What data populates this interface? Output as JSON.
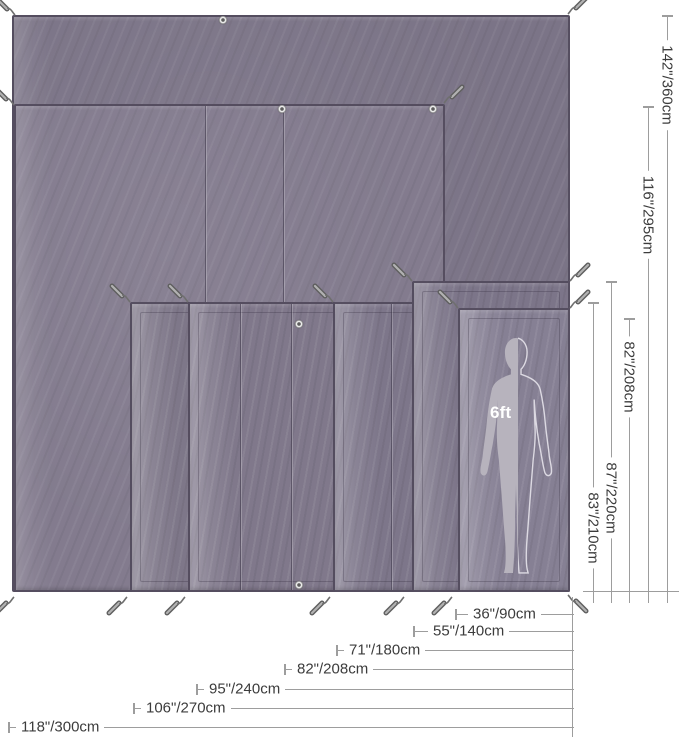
{
  "figure": {
    "background": "#ffffff",
    "scale_reference": {
      "label": "6ft"
    },
    "height_dimensions": [
      {
        "label": "142\"/360cm",
        "line_x": 667,
        "top_y": 15,
        "label_center_y": 85
      },
      {
        "label": "116\"/295cm",
        "line_x": 648,
        "top_y": 106,
        "label_center_y": 215
      },
      {
        "label": "82\"/208cm",
        "line_x": 629,
        "top_y": 318,
        "label_center_y": 377
      },
      {
        "label": "87\"/220cm",
        "line_x": 611,
        "top_y": 281,
        "label_center_y": 498
      },
      {
        "label": "83\"/210cm",
        "line_x": 593,
        "top_y": 302,
        "label_center_y": 528
      }
    ],
    "width_dimensions": [
      {
        "label": "36\"/90cm",
        "line_y": 614,
        "tick_x": 455,
        "text_x": 468
      },
      {
        "label": "55\"/140cm",
        "line_y": 631,
        "tick_x": 413,
        "text_x": 428
      },
      {
        "label": "71\"/180cm",
        "line_y": 650,
        "tick_x": 336,
        "text_x": 344
      },
      {
        "label": "82\"/208cm",
        "line_y": 669,
        "tick_x": 284,
        "text_x": 292
      },
      {
        "label": "95\"/240cm",
        "line_y": 689,
        "tick_x": 196,
        "text_x": 204
      },
      {
        "label": "106\"/270cm",
        "line_y": 708,
        "tick_x": 133,
        "text_x": 141
      },
      {
        "label": "118\"/300cm",
        "line_y": 727,
        "tick_x": 8,
        "text_x": 16
      }
    ],
    "colors": {
      "fabric_dark": "#7b7487",
      "fabric_mid": "#837b8e",
      "fabric_light": "#868094",
      "edge": "#5a5364",
      "dimension_line": "#9d9d9d",
      "dimension_text": "#3c3c3c",
      "silhouette_fill": "#b7b3bd",
      "silhouette_outline": "#dcd9e2"
    },
    "tarps": [
      {
        "name": "tarp-largest",
        "x": 12,
        "y": 15,
        "w": 558,
        "h": 577,
        "fill": "#7b7487",
        "strip": false
      },
      {
        "name": "tarp-second",
        "x": 14,
        "y": 104,
        "w": 431,
        "h": 488,
        "fill": "#837b8e",
        "strip": false
      },
      {
        "name": "tarp-strip-1",
        "x": 130,
        "y": 302,
        "w": 440,
        "h": 290,
        "fill": "#7e7789",
        "strip": true
      },
      {
        "name": "tarp-strip-2",
        "x": 188,
        "y": 302,
        "w": 382,
        "h": 290,
        "fill": "#80788b",
        "strip": true
      },
      {
        "name": "tarp-strip-3",
        "x": 333,
        "y": 302,
        "w": 237,
        "h": 290,
        "fill": "#7d768a",
        "strip": true
      },
      {
        "name": "tarp-strip-4",
        "x": 412,
        "y": 281,
        "w": 158,
        "h": 311,
        "fill": "#7c7589",
        "strip": true
      },
      {
        "name": "tarp-strip-5",
        "x": 458,
        "y": 308,
        "w": 112,
        "h": 284,
        "fill": "#868094",
        "strip": true
      }
    ],
    "seams": [
      {
        "x": 205,
        "y1": 106,
        "y2": 302
      },
      {
        "x": 283,
        "y1": 106,
        "y2": 302
      },
      {
        "x": 240,
        "y1": 304,
        "y2": 590
      },
      {
        "x": 291,
        "y1": 304,
        "y2": 590
      },
      {
        "x": 391,
        "y1": 304,
        "y2": 590
      }
    ],
    "grommets": [
      {
        "x": 223,
        "y": 20
      },
      {
        "x": 282,
        "y": 109
      },
      {
        "x": 433,
        "y": 109
      },
      {
        "x": 299,
        "y": 324
      },
      {
        "x": 299,
        "y": 585
      }
    ],
    "stakes": [
      {
        "x": -7,
        "y": -6,
        "dir": "nw"
      },
      {
        "x": 564,
        "y": -7,
        "dir": "ne"
      },
      {
        "x": -8,
        "y": 84,
        "dir": "nw"
      },
      {
        "x": 440,
        "y": 82,
        "dir": "ne"
      },
      {
        "x": 108,
        "y": 281,
        "dir": "nw"
      },
      {
        "x": 166,
        "y": 281,
        "dir": "nw"
      },
      {
        "x": 311,
        "y": 281,
        "dir": "nw"
      },
      {
        "x": 390,
        "y": 260,
        "dir": "nw"
      },
      {
        "x": 566,
        "y": 260,
        "dir": "ne"
      },
      {
        "x": 436,
        "y": 287,
        "dir": "nw"
      },
      {
        "x": 566,
        "y": 287,
        "dir": "ne"
      },
      {
        "x": -8,
        "y": 592,
        "dir": "sw"
      },
      {
        "x": 105,
        "y": 592,
        "dir": "sw"
      },
      {
        "x": 163,
        "y": 592,
        "dir": "sw"
      },
      {
        "x": 308,
        "y": 592,
        "dir": "sw"
      },
      {
        "x": 382,
        "y": 592,
        "dir": "sw"
      },
      {
        "x": 430,
        "y": 592,
        "dir": "sw"
      },
      {
        "x": 564,
        "y": 590,
        "dir": "se"
      }
    ],
    "guides": {
      "height_baseline": {
        "y": 591,
        "x1": 583,
        "x2": 679
      },
      "height_line_bottom": 603,
      "width_connector": {
        "x": 572,
        "y1": 597,
        "y2": 737
      },
      "width_line_right": 574
    },
    "silhouette": {
      "x": 465,
      "y": 335,
      "w": 102,
      "h": 242,
      "label_x": 490,
      "label_y": 403
    }
  }
}
